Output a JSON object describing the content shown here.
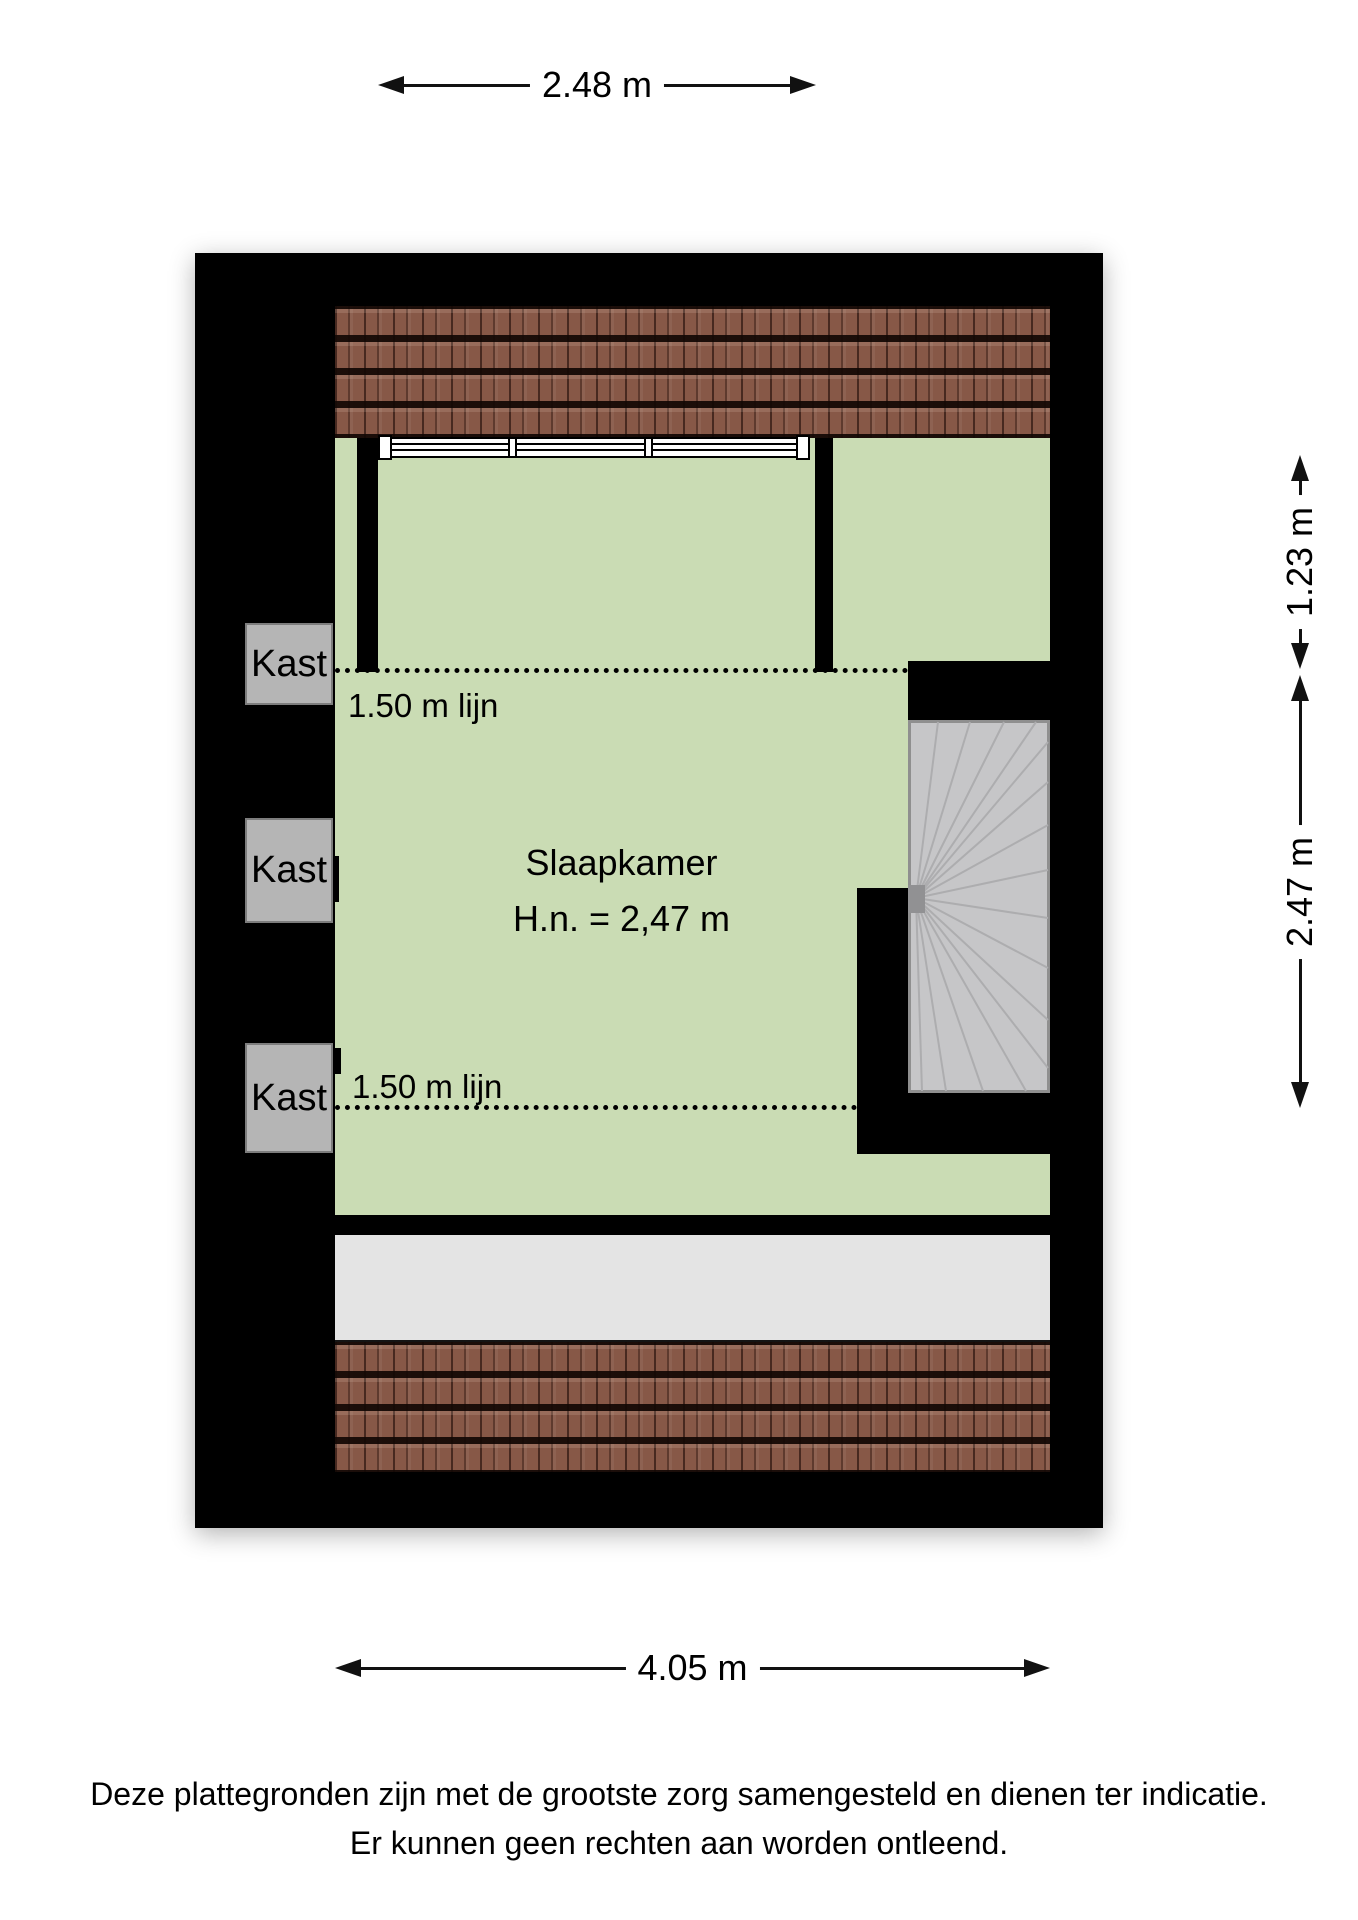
{
  "plan": {
    "room": {
      "name": "Slaapkamer",
      "height_label": "H.n. = 2,47 m"
    },
    "height_lines": [
      {
        "label": "1.50 m lijn"
      },
      {
        "label": "1.50 m lijn"
      }
    ],
    "closets": [
      {
        "label": "Kast"
      },
      {
        "label": "Kast"
      },
      {
        "label": "Kast"
      }
    ],
    "colors": {
      "wall": "#000000",
      "floor_green": "#cadcb4",
      "roof_tile": "#875847",
      "stair_gray": "#c6c6c8",
      "closet_gray": "#b5b5b5",
      "landing_gray": "#e4e4e4"
    }
  },
  "dimensions": {
    "top": "2.48 m",
    "right_upper": "1.23 m",
    "right_lower": "2.47 m",
    "bottom": "4.05 m"
  },
  "disclaimer": {
    "line1": "Deze plattegronden zijn met de grootste zorg samengesteld en dienen ter indicatie.",
    "line2": "Er kunnen geen rechten aan worden ontleend."
  }
}
